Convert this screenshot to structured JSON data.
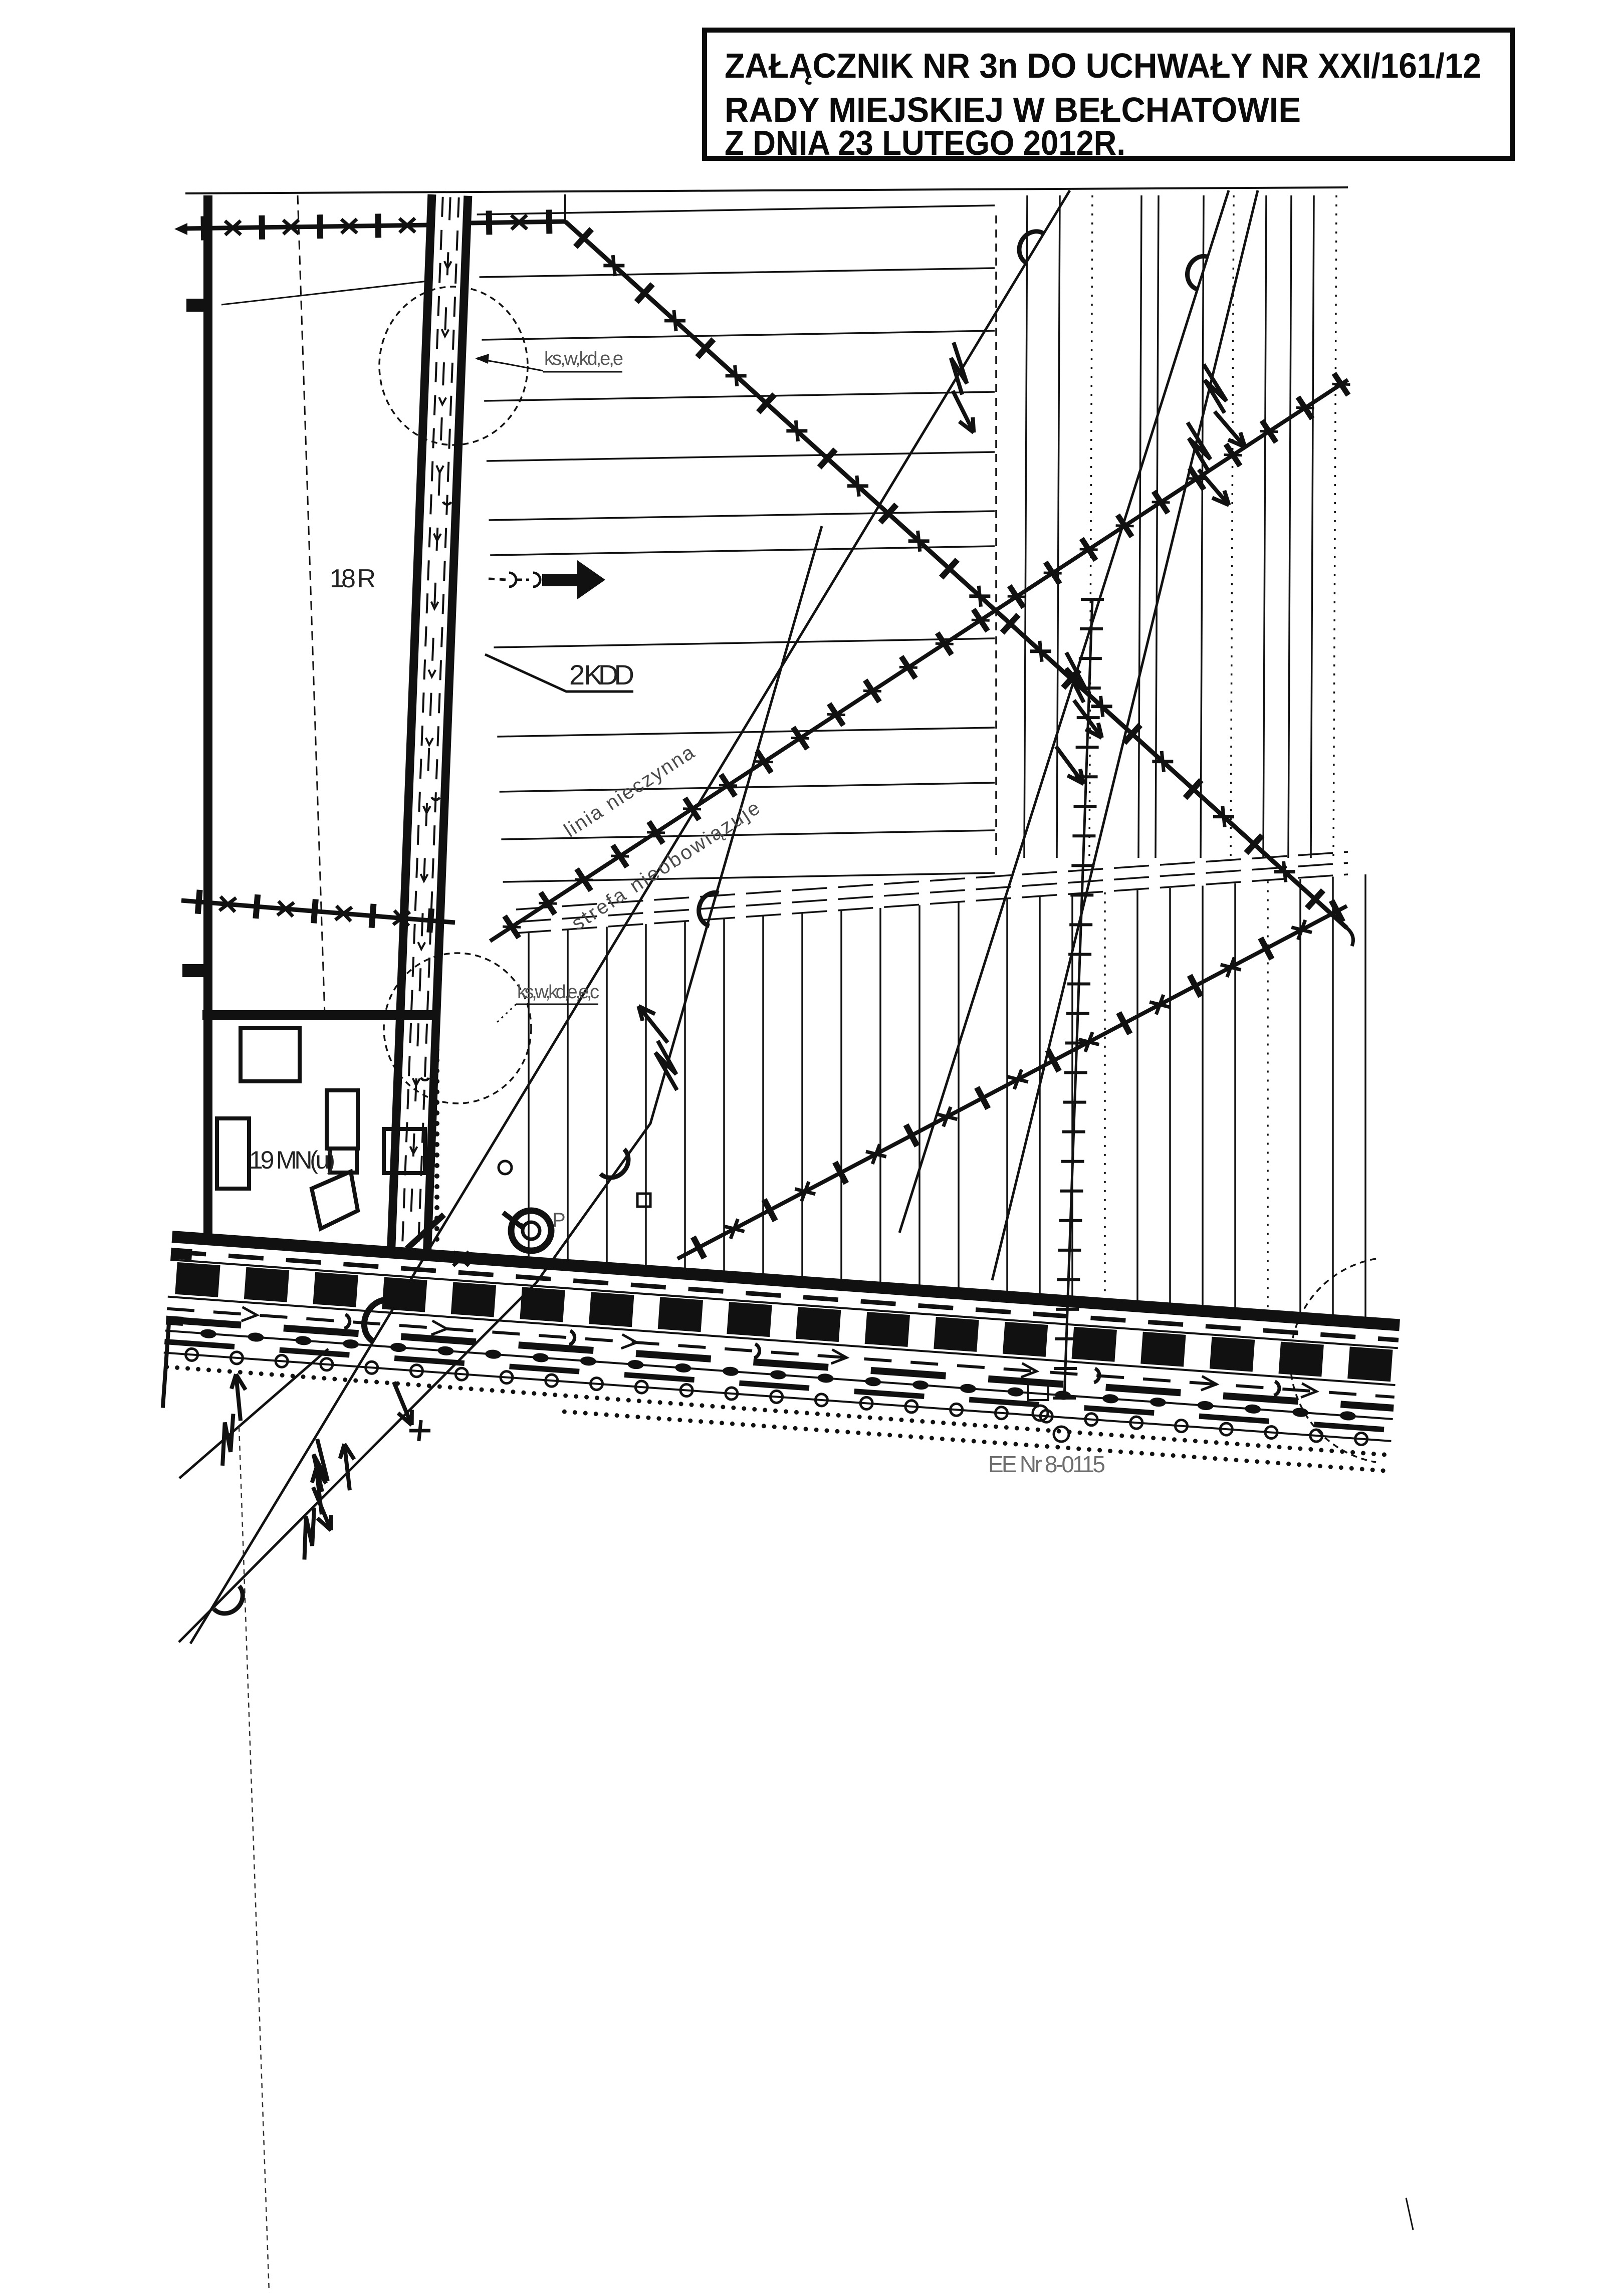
{
  "title_block": {
    "lines": [
      "ZAŁĄCZNIK NR 3n DO UCHWAŁY NR XXI/161/12",
      "RADY MIEJSKIEJ W BEŁCHATOWIE",
      "Z DNIA 23 LUTEGO 2012R."
    ]
  },
  "labels": {
    "zone_18r": "18 R",
    "road_2kdd": "2 KDD",
    "zone_19mnu": "19 MN(u)",
    "utilities_top": "ks,w,kd,e,e",
    "utilities_mid": "ks,w,kd,e,e,c",
    "inactive_line_1": "linia nieczynna",
    "inactive_line_2": "strefa nieobowiązuje",
    "power_line_id": "EE Nr 8-0115",
    "pump_symbol": "P"
  },
  "colors": {
    "ink": "#111111",
    "light_ink": "#555555",
    "faint_ink": "#6e6e6e"
  }
}
